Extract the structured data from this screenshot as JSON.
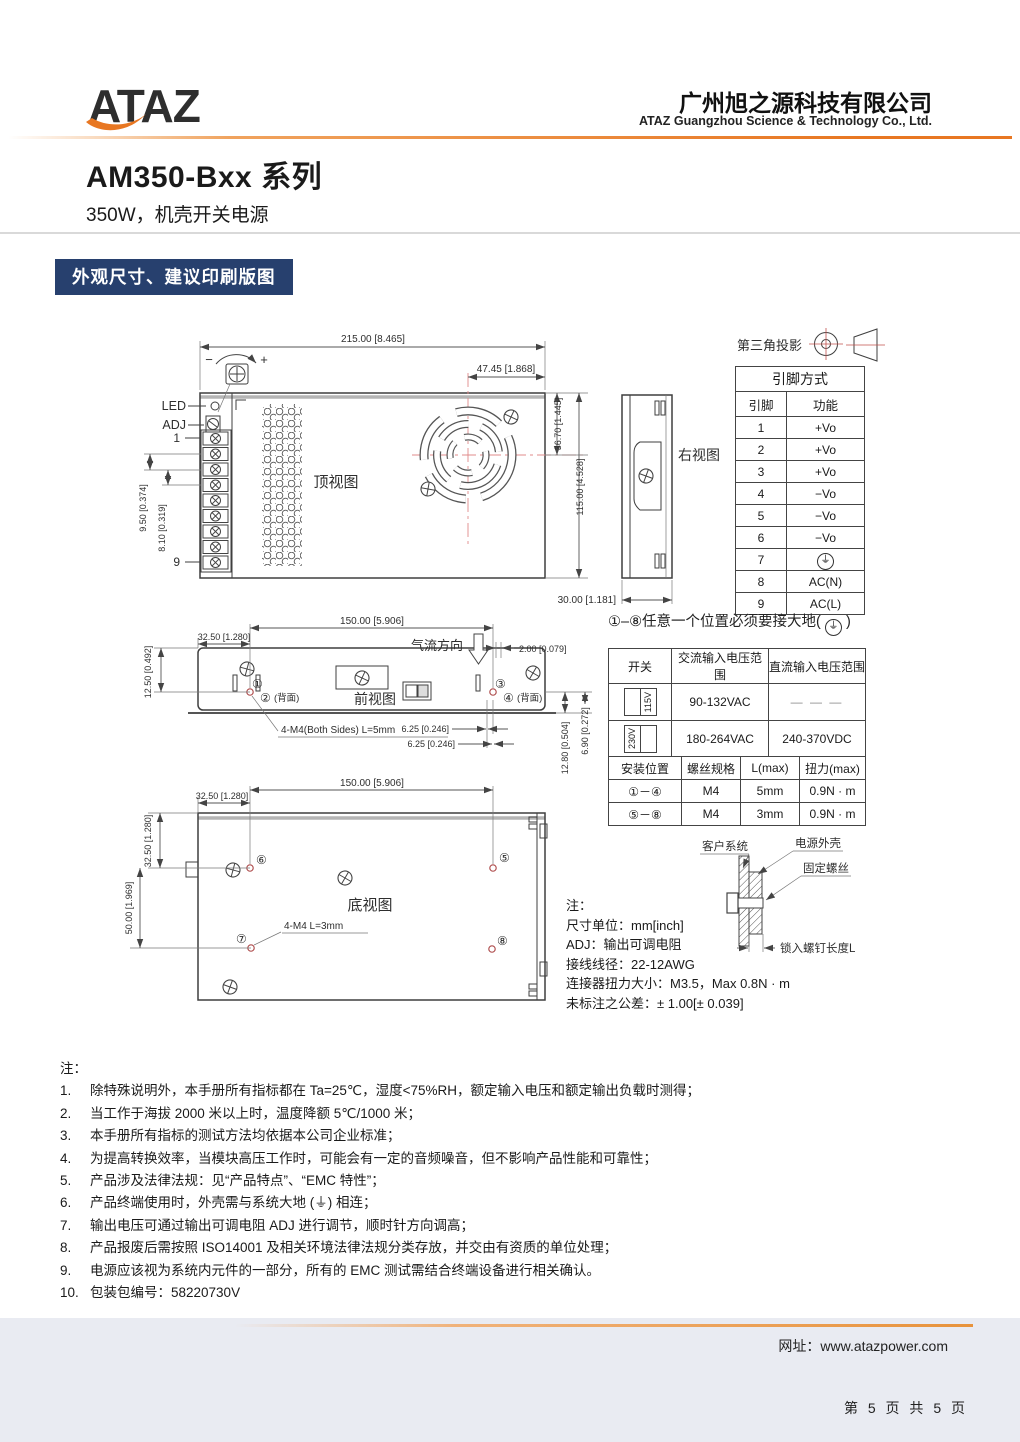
{
  "header": {
    "logo": "ATAZ",
    "company_cn": "广州旭之源科技有限公司",
    "company_en": "ATAZ Guangzhou Science & Technology Co., Ltd."
  },
  "title": {
    "model": "AM350-Bxx 系列",
    "sub": "350W，机壳开关电源"
  },
  "section": {
    "heading": "外观尺寸、建议印刷版图"
  },
  "projection": {
    "label": "第三角投影"
  },
  "pin_table": {
    "title": "引脚方式",
    "col_pin": "引脚",
    "col_func": "功能",
    "rows": [
      {
        "pin": "1",
        "func": "+Vo"
      },
      {
        "pin": "2",
        "func": "+Vo"
      },
      {
        "pin": "3",
        "func": "+Vo"
      },
      {
        "pin": "4",
        "func": "−Vo"
      },
      {
        "pin": "5",
        "func": "−Vo"
      },
      {
        "pin": "6",
        "func": "−Vo"
      },
      {
        "pin": "7",
        "func": "⏚"
      },
      {
        "pin": "8",
        "func": "AC(N)"
      },
      {
        "pin": "9",
        "func": "AC(L)"
      }
    ]
  },
  "ground_note": {
    "pre": "①–⑧任意一个位置必须要接大地(",
    "glyph": "⏚",
    "post": ")"
  },
  "io_table": {
    "col_switch": "开关",
    "col_ac": "交流输入电压范围",
    "col_dc": "直流输入电压范围",
    "rows": [
      {
        "switch": "115V",
        "ac": "90-132VAC",
        "dc": "— — —"
      },
      {
        "switch": "230V",
        "ac": "180-264VAC",
        "dc": "240-370VDC"
      }
    ]
  },
  "mount_table": {
    "col_pos": "安装位置",
    "col_spec": "螺丝规格",
    "col_l": "L(max)",
    "col_torque": "扭力(max)",
    "rows": [
      {
        "pos": "①－④",
        "spec": "M4",
        "l": "5mm",
        "torque": "0.9N · m"
      },
      {
        "pos": "⑤－⑧",
        "spec": "M4",
        "l": "3mm",
        "torque": "0.9N · m"
      }
    ]
  },
  "mount_diagram": {
    "customer": "客户系统",
    "case": "电源外壳",
    "screw": "固定螺丝",
    "depth": "锁入螺钉长度L"
  },
  "views": {
    "top": {
      "label": "顶视图",
      "led": "LED",
      "adj": "ADJ",
      "pin1": "1",
      "pin9": "9",
      "minus": "−",
      "plus": "+",
      "dim_width": "215.00 [8.465]",
      "dim_fan_x": "47.45 [1.868]",
      "dim_fan_y": "36.70 [1.445]",
      "dim_height": "115.00 [4.528]",
      "dim_p950": "9.50 [0.374]",
      "dim_p810": "8.10 [0.319]"
    },
    "right": {
      "label": "右视图",
      "dim_depth": "30.00 [1.181]"
    },
    "front": {
      "label": "前视图",
      "airflow": "气流方向",
      "dim_span": "150.00 [5.906]",
      "dim_left": "32.50 [1.280]",
      "dim_top": "12.50 [0.492]",
      "dim_edge": "2.00 [0.079]",
      "dim_625a": "6.25 [0.246]",
      "dim_625b": "6.25 [0.246]",
      "dim_1280": "12.80 [0.504]",
      "dim_690": "6.90 [0.272]",
      "c1": "①",
      "c2": "②",
      "c2s": "(背面)",
      "c3": "③",
      "c4": "④",
      "c4s": "(背面)",
      "screw_note": "4-M4(Both Sides) L=5mm"
    },
    "bottom": {
      "label": "底视图",
      "dim_span": "150.00 [5.906]",
      "dim_left": "32.50 [1.280]",
      "dim_v325": "32.50 [1.280]",
      "dim_v50": "50.00 [1.969]",
      "c5": "⑤",
      "c6": "⑥",
      "c7": "⑦",
      "c8": "⑧",
      "screw_note": "4-M4 L=3mm"
    }
  },
  "spec_notes": {
    "title": "注：",
    "lines": [
      "尺寸单位：mm[inch]",
      "ADJ：输出可调电阻",
      "接线线径：22-12AWG",
      "连接器扭力大小：M3.5，Max 0.8N · m",
      "未标注之公差：± 1.00[± 0.039]"
    ]
  },
  "notes": {
    "title": "注：",
    "items": [
      {
        "num": "1.",
        "text": "除特殊说明外，本手册所有指标都在 Ta=25℃，湿度<75%RH，额定输入电压和额定输出负载时测得；"
      },
      {
        "num": "2.",
        "text": "当工作于海拔 2000 米以上时，温度降额 5℃/1000 米；"
      },
      {
        "num": "3.",
        "text": "本手册所有指标的测试方法均依据本公司企业标准；"
      },
      {
        "num": "4.",
        "text": "为提高转换效率，当模块高压工作时，可能会有一定的音频噪音，但不影响产品性能和可靠性；"
      },
      {
        "num": "5.",
        "text": "产品涉及法律法规：见“产品特点”、“EMC 特性”；"
      },
      {
        "num": "6.",
        "text": "产品终端使用时，外壳需与系统大地 (⏚) 相连；"
      },
      {
        "num": "7.",
        "text": "输出电压可通过输出可调电阻 ADJ 进行调节，顺时针方向调高；"
      },
      {
        "num": "8.",
        "text": "产品报废后需按照 ISO14001 及相关环境法律法规分类存放，并交由有资质的单位处理；"
      },
      {
        "num": "9.",
        "text": "电源应该视为系统内元件的一部分，所有的 EMC 测试需结合终端设备进行相关确认。"
      },
      {
        "num": "10.",
        "text": "包装包编号：58220730V"
      }
    ]
  },
  "footer": {
    "website": "网址：www.atazpower.com",
    "page": "第 5 页 共 5 页"
  }
}
